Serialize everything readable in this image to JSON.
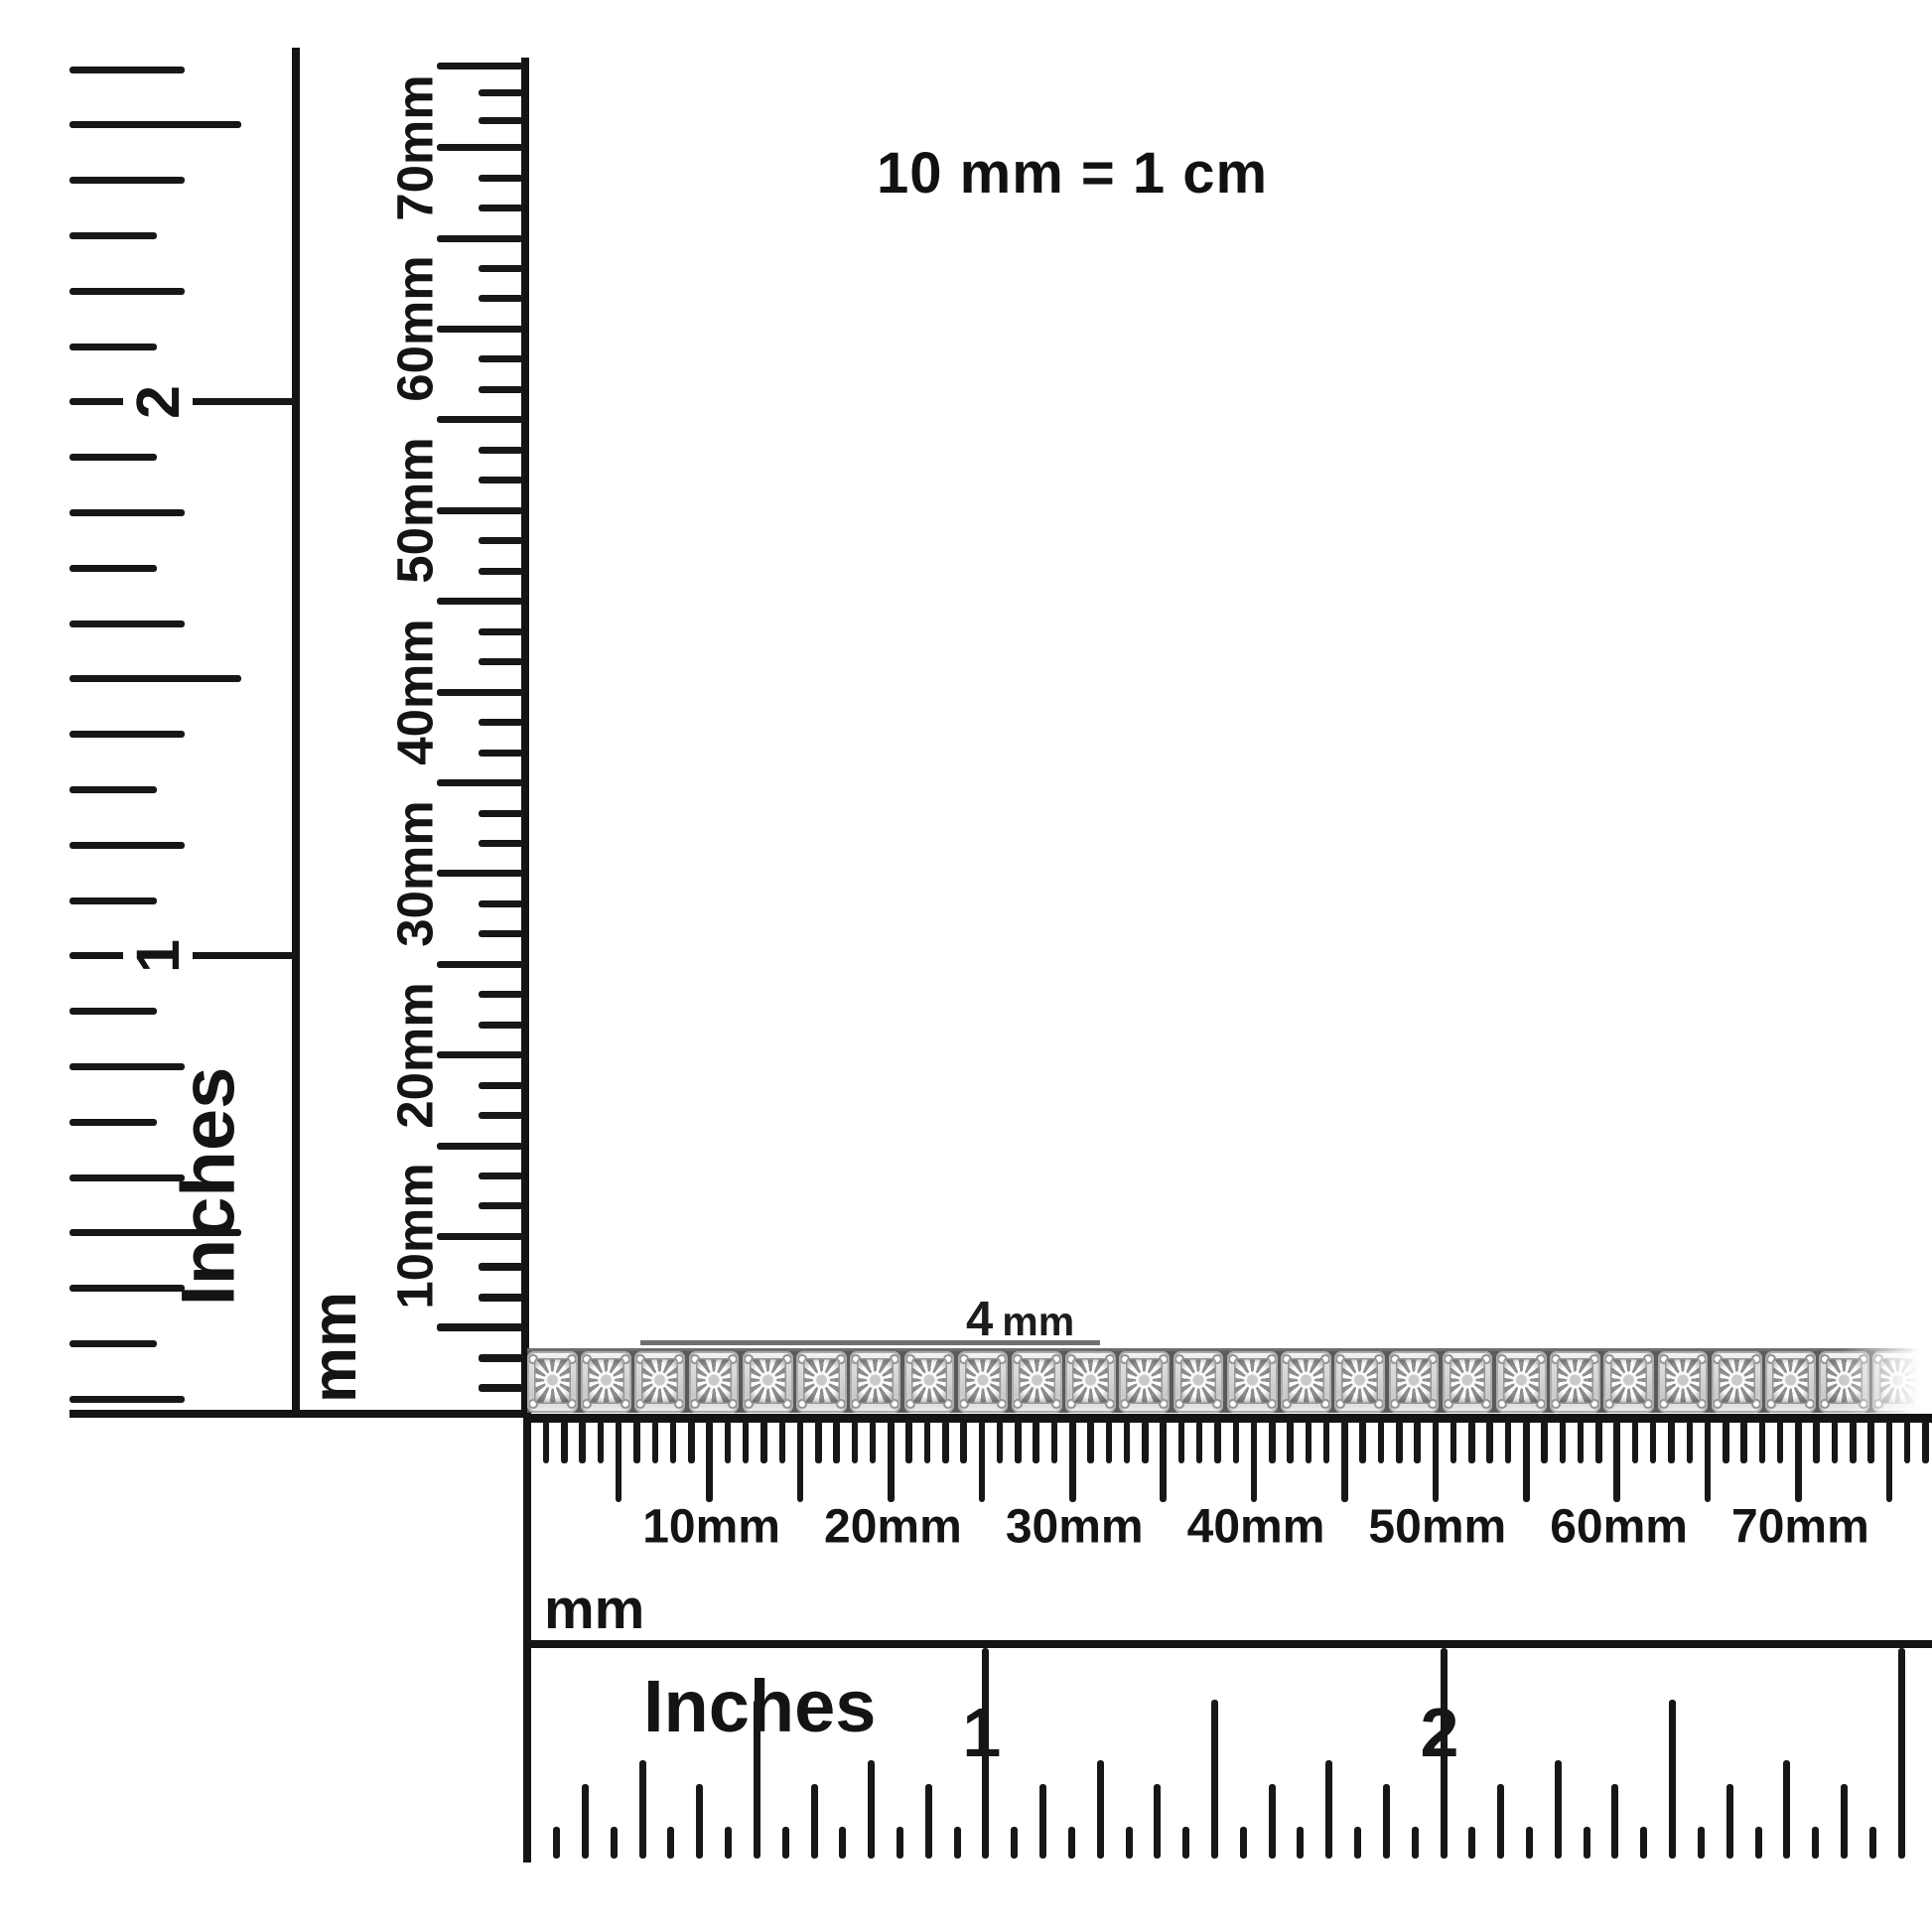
{
  "scale_note": "10 mm = 1 cm",
  "width_annotation": {
    "value": "4",
    "unit": "mm",
    "label": "4 mm"
  },
  "rulers": {
    "left_inches": {
      "unit": "Inches",
      "numbers": [
        "2",
        "1"
      ]
    },
    "vertical_mm": {
      "unit": "mm",
      "tick_labels": [
        "70mm",
        "60mm",
        "50mm",
        "40mm",
        "30mm",
        "20mm",
        "10mm"
      ]
    },
    "horizontal_mm": {
      "unit": "mm",
      "tick_labels": [
        "10mm",
        "20mm",
        "30mm",
        "40mm",
        "50mm",
        "60mm",
        "70mm"
      ]
    },
    "bottom_inches": {
      "unit": "Inches",
      "numbers": [
        "1",
        "2"
      ]
    }
  },
  "item": {
    "name": "diamond tennis bracelet",
    "link_count": 26,
    "width_label": "4 mm"
  },
  "colors": {
    "ink": "#161616",
    "annotation_line": "#6f6f6f",
    "metal_light": "#f5f5f5",
    "metal_mid": "#d2d2d2",
    "metal_dark": "#5a5a5a"
  }
}
